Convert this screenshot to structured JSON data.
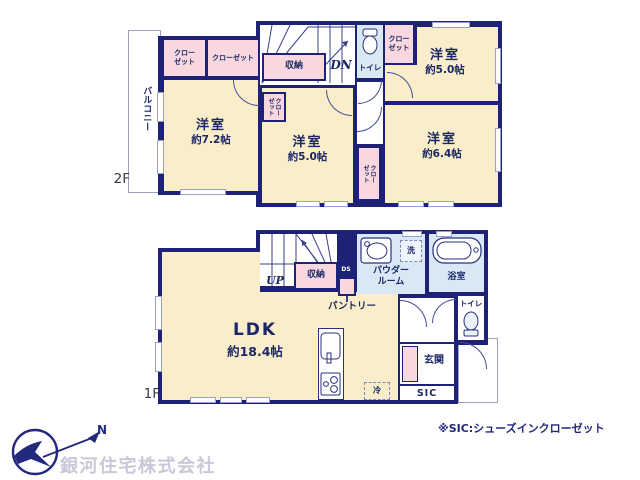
{
  "floor2": {
    "label": "2F",
    "balcony": "バルコニー",
    "closet_nw_a": "クローゼット",
    "closet_nw_b": "クローゼット",
    "storage": "収納",
    "stairs_dn": "DN",
    "toilet": "トイレ",
    "closet_ne": "クローゼット",
    "closet_center": "クローゼット",
    "closet_mid": "クローゼット",
    "room_nw_name": "洋室",
    "room_nw_size": "約7.2帖",
    "room_center_name": "洋室",
    "room_center_size": "約5.0帖",
    "room_ne_name": "洋室",
    "room_ne_size": "約5.0帖",
    "room_se_name": "洋室",
    "room_se_size": "約6.4帖"
  },
  "floor1": {
    "label": "1F",
    "stairs_up": "UP",
    "storage": "収納",
    "duct": "DS",
    "pantry": "パントリー",
    "powder_room": "パウダールーム",
    "laundry": "洗",
    "bathroom": "浴室",
    "toilet": "トイレ",
    "entrance": "玄関",
    "shoes_closet": "SIC",
    "fridge": "冷",
    "ldk_name": "LDK",
    "ldk_size": "約18.4帖"
  },
  "footer": {
    "company": "銀河住宅株式会社",
    "compass_n": "N",
    "note": "※SIC:シューズインクローゼット"
  },
  "colors": {
    "wall": "#1e2277",
    "room": "#faeeca",
    "closet": "#f8d8de",
    "wet_area": "#d9e8f5",
    "logo_text": "#c8c8da",
    "note_text": "#23297d"
  }
}
